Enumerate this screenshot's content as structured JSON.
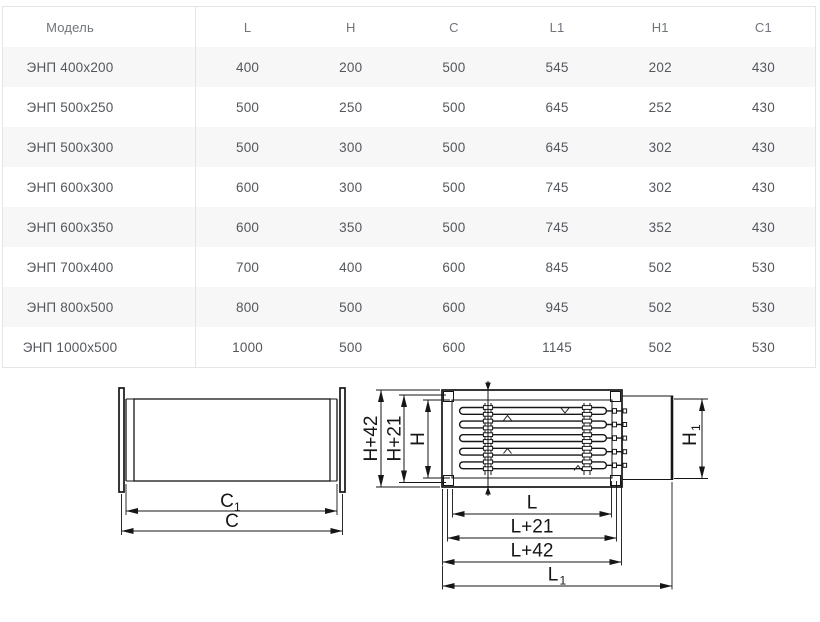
{
  "table": {
    "columns": [
      "Модель",
      "L",
      "H",
      "C",
      "L1",
      "H1",
      "C1"
    ],
    "rows": [
      [
        "ЭНП 400x200",
        "400",
        "200",
        "500",
        "545",
        "202",
        "430"
      ],
      [
        "ЭНП 500x250",
        "500",
        "250",
        "500",
        "645",
        "252",
        "430"
      ],
      [
        "ЭНП 500x300",
        "500",
        "300",
        "500",
        "645",
        "302",
        "430"
      ],
      [
        "ЭНП 600x300",
        "600",
        "300",
        "500",
        "745",
        "302",
        "430"
      ],
      [
        "ЭНП 600x350",
        "600",
        "350",
        "500",
        "745",
        "352",
        "430"
      ],
      [
        "ЭНП 700x400",
        "700",
        "400",
        "600",
        "845",
        "502",
        "530"
      ],
      [
        "ЭНП 800x500",
        "800",
        "500",
        "600",
        "945",
        "502",
        "530"
      ],
      [
        "ЭНП 1000x500",
        "1000",
        "500",
        "600",
        "1145",
        "502",
        "530"
      ]
    ],
    "stripe_color": "#f7f7f8",
    "border_color": "#e5e5e8",
    "header_text_color": "#71757b",
    "text_color": "#54575c"
  },
  "diagrams": {
    "line_color": "#161616",
    "duct_side_view": {
      "dim_inner_main": "C",
      "dim_inner_sub": "1",
      "dim_outer": "C"
    },
    "heater_front_view": {
      "dim_height_outer": "H+42",
      "dim_height_mid": "H+21",
      "dim_height_inner": "H",
      "dim_height_duct_main": "H",
      "dim_height_duct_sub": "1",
      "dim_length_inner": "L",
      "dim_length_mid": "L+21",
      "dim_length_outer": "L+42",
      "dim_length_duct_main": "L",
      "dim_length_duct_sub": "1"
    }
  }
}
